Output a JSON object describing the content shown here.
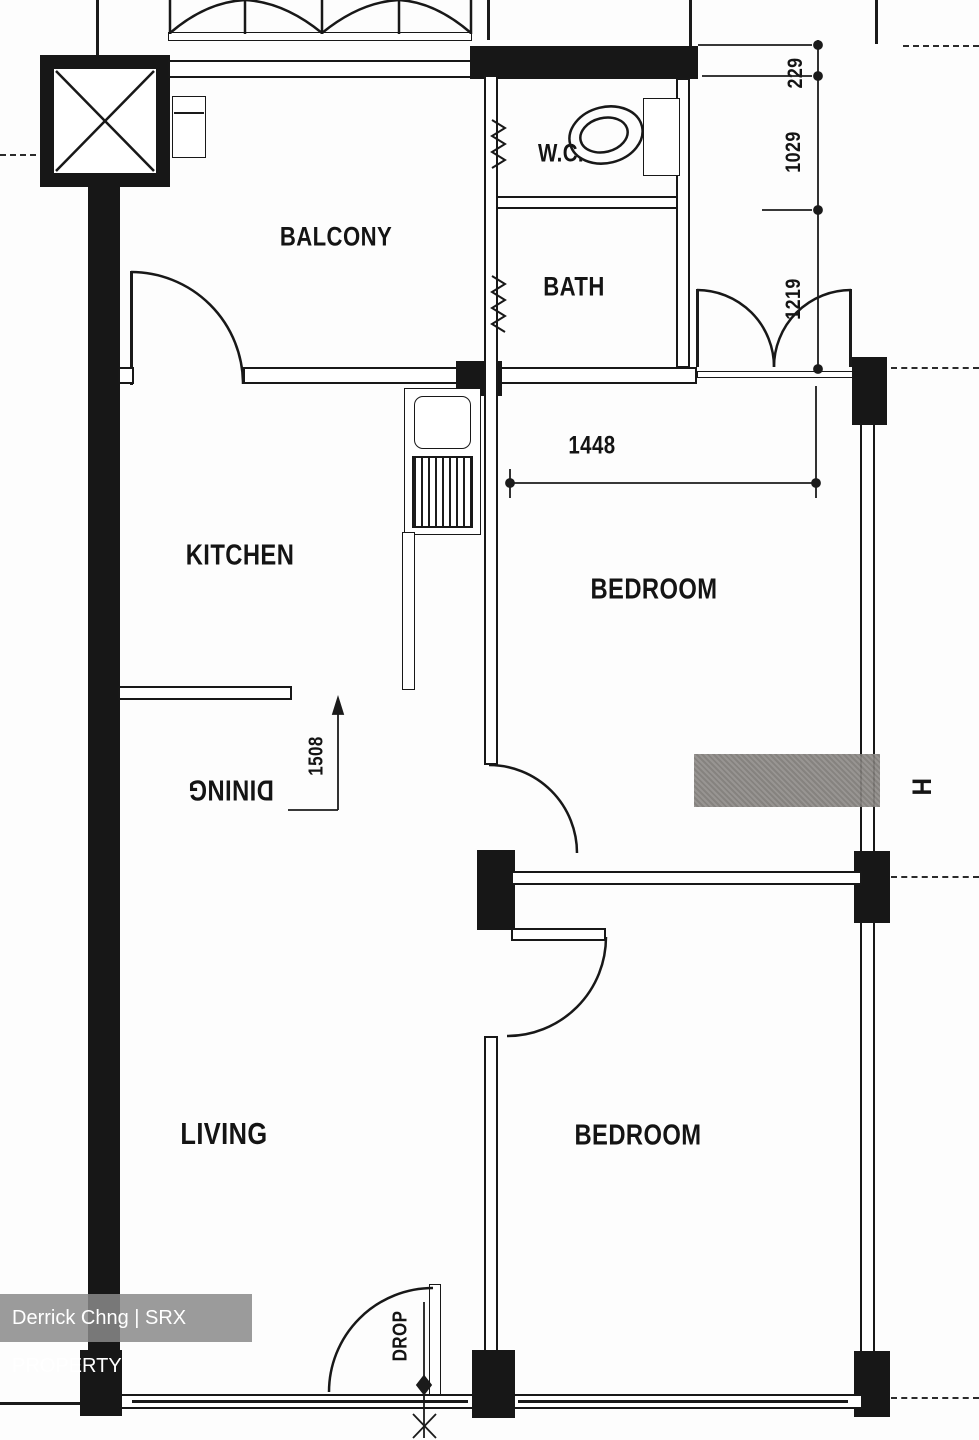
{
  "rooms": {
    "balcony": "BALCONY",
    "wc": "W.C.",
    "bath": "BATH",
    "kitchen": "KITCHEN",
    "bedroom1": "BEDROOM",
    "dining": "DINING",
    "living": "LIVING",
    "bedroom2": "BEDROOM",
    "drop": "DROP"
  },
  "dimensions": {
    "d229": "229",
    "d1029": "1029",
    "d1219": "1219",
    "d1448": "1448",
    "d1508": "1508"
  },
  "symbols": {
    "beam_marker": "H"
  },
  "watermark": {
    "text": "Derrick Chng | SRX PROPERTY"
  },
  "colors": {
    "ink": "#171717",
    "marker_gray": "#8a8784",
    "watermark_bg": "#8a8a8a"
  }
}
